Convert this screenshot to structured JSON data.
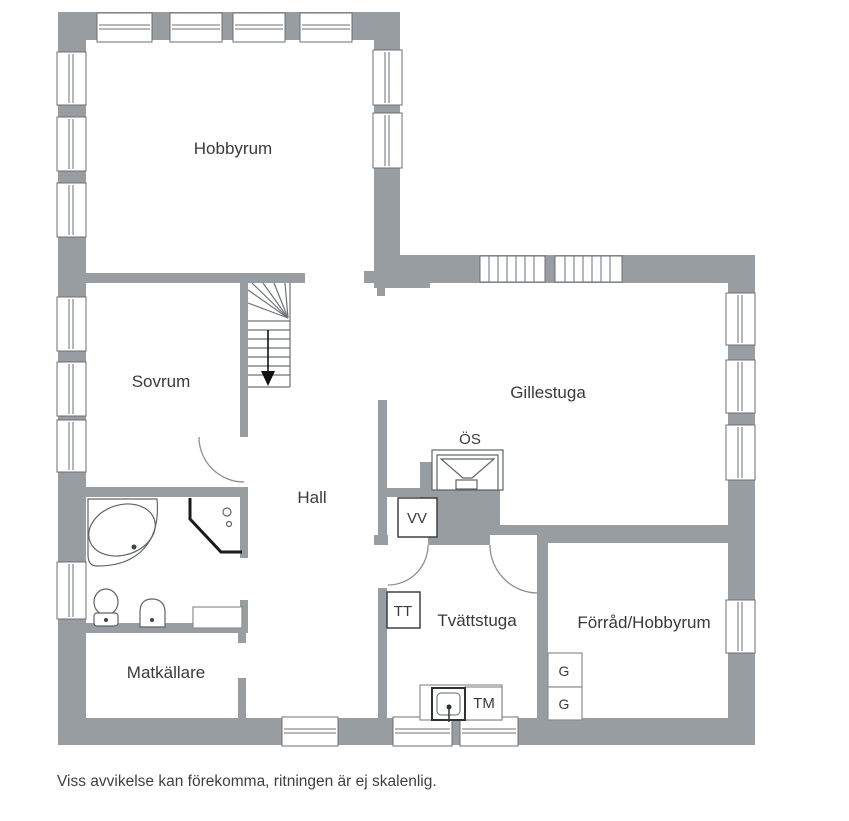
{
  "labels": {
    "hobbyrum": "Hobbyrum",
    "sovrum": "Sovrum",
    "gillestuga": "Gillestuga",
    "hall": "Hall",
    "matkallare": "Matkällare",
    "tvattstuga": "Tvättstuga",
    "forrad_hobbyrum": "Förråd/Hobbyrum",
    "os": "ÖS",
    "vv": "VV",
    "tt": "TT",
    "tm": "TM",
    "g1": "G",
    "g2": "G"
  },
  "footer": {
    "disclaimer": "Viss avvikelse kan förekomma, ritningen är ej skalenlig."
  },
  "colors": {
    "wall": "#989da2",
    "outline": "#6b7075",
    "fixture": "#4a4f53",
    "door": "#8a8f94",
    "stair": "#6e7377",
    "arrow": "#111111",
    "text": "#3a3a3a",
    "background": "#ffffff"
  }
}
